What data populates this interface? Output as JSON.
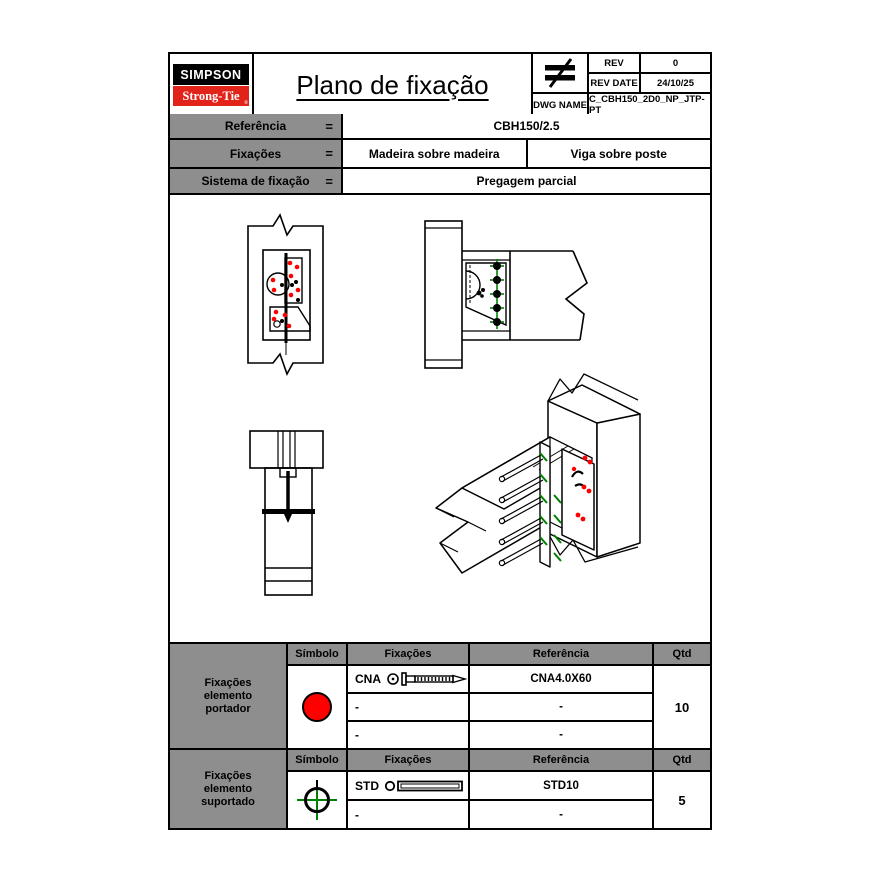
{
  "header": {
    "brand": {
      "line1": "SIMPSON",
      "line2": "Strong-Tie",
      "registered": "®"
    },
    "title": "Plano de fixação",
    "scale_icon": "not-equal-symbol",
    "rev": {
      "rev_label": "REV",
      "rev_value": "0",
      "rev_date_label": "REV DATE",
      "rev_date_value": "24/10/25",
      "dwg_label": "DWG NAME",
      "dwg_value": "C_CBH150_2D0_NP_JTP-PT"
    }
  },
  "info": {
    "rows": [
      {
        "label": "Referência",
        "eq": "=",
        "values": [
          "CBH150/2.5"
        ]
      },
      {
        "label": "Fixações",
        "eq": "=",
        "values": [
          "Madeira sobre madeira",
          "Viga sobre poste"
        ]
      },
      {
        "label": "Sistema de fixação",
        "eq": "=",
        "values": [
          "Pregagem parcial"
        ]
      }
    ]
  },
  "portador": {
    "group": [
      "Fixações",
      "elemento",
      "portador"
    ],
    "headers": {
      "simbolo": "Símbolo",
      "fixacoes": "Fixações",
      "referencia": "Referência",
      "qtd": "Qtd"
    },
    "symbol": "red-filled-circle",
    "rows": [
      {
        "fix": "CNA",
        "icon": "ring-shank-nail",
        "ref": "CNA4.0X60"
      },
      {
        "fix": "-",
        "ref": "-"
      },
      {
        "fix": "-",
        "ref": "-"
      }
    ],
    "qtd": "10"
  },
  "suportado": {
    "group": [
      "Fixações",
      "elemento",
      "suportado"
    ],
    "headers": {
      "simbolo": "Símbolo",
      "fixacoes": "Fixações",
      "referencia": "Referência",
      "qtd": "Qtd"
    },
    "symbol": "green-crosshair-circle",
    "rows": [
      {
        "fix": "STD",
        "icon": "dowel",
        "ref": "STD10"
      },
      {
        "fix": "-",
        "ref": "-"
      }
    ],
    "qtd": "5"
  },
  "colors": {
    "logo_red": "#e2231a",
    "nail_symbol_red": "#ff0000",
    "dowel_symbol_green": "#008000",
    "label_cell_gray": "#8e8e8e"
  }
}
